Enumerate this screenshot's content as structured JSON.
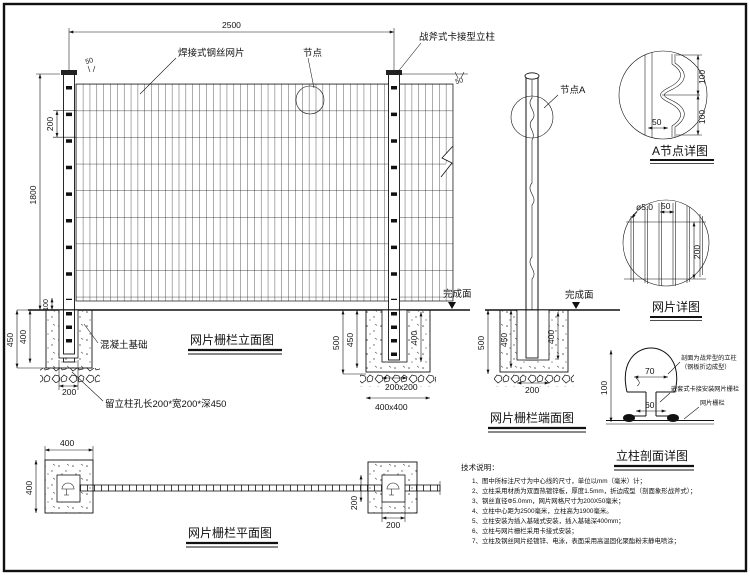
{
  "elevation": {
    "title": "网片栅栏立面图",
    "dim_2500": "2500",
    "dim_50_left": "50",
    "dim_50_right": "50",
    "dim_1800": "1800",
    "dim_200_pitch": "200",
    "dim_100": "100",
    "dim_450": "450",
    "dim_400": "400",
    "dim_200_hole": "200",
    "label_mesh": "焊接式钢丝网片",
    "label_node": "节点",
    "label_post": "战斧式卡接型立柱",
    "label_concrete": "混凝土基础",
    "label_hole": "留立柱孔长200*宽200*深450",
    "right_foundation": {
      "dim_500": "500",
      "dim_450": "450",
      "dim_400": "400",
      "dim_200x200": "200x200",
      "dim_400x400": "400x400",
      "label_finish": "完成面"
    }
  },
  "end_view": {
    "title": "网片栅栏端面图",
    "label_node_a": "节点A",
    "label_finish": "完成面",
    "dim_500": "500",
    "dim_450": "450",
    "dim_400": "400",
    "dim_200": "200"
  },
  "detail_a": {
    "title": "A节点详图",
    "dim_100_top": "100",
    "dim_100_bottom": "100",
    "dim_50": "50"
  },
  "mesh_detail": {
    "title": "网片详图",
    "dim_dia": "ø5.0",
    "dim_50": "50",
    "dim_200": "200"
  },
  "post_section": {
    "title": "立柱剖面详图",
    "dim_100": "100",
    "dim_70": "70",
    "dim_60": "60",
    "label_profile_line1": "剖面为战斧型的立柱",
    "label_profile_line2": "（钢板折边成型）",
    "label_clamp": "嵌套式卡接安装网片栅栏",
    "label_mesh": "网片栅栏"
  },
  "plan": {
    "title": "网片栅栏平面图",
    "dim_400_top": "400",
    "dim_400_left": "400",
    "dim_200_vertical": "200",
    "dim_200_horizontal": "200"
  },
  "notes": {
    "heading": "技术说明：",
    "items": [
      "1、图中所标注尺寸为中心线的尺寸，单位以mm（毫米）计；",
      "2、立柱采用材质为双面热镀锌板，厚度1.5mm，折边成型（剖面象形战斧式）；",
      "3、钢丝直径Φ5.0mm，网片网格尺寸为200X50毫米；",
      "4、立柱中心距为2500毫米，立柱高为1900毫米。",
      "5、立柱安装为插入基础式安装，插入基础深400mm；",
      "6、立柱与网片栅栏采用卡接式安装；",
      "7、立柱及钢丝网片经镀锌、电泳，表面采用高温固化聚酯粉末静电喷涂；"
    ]
  }
}
